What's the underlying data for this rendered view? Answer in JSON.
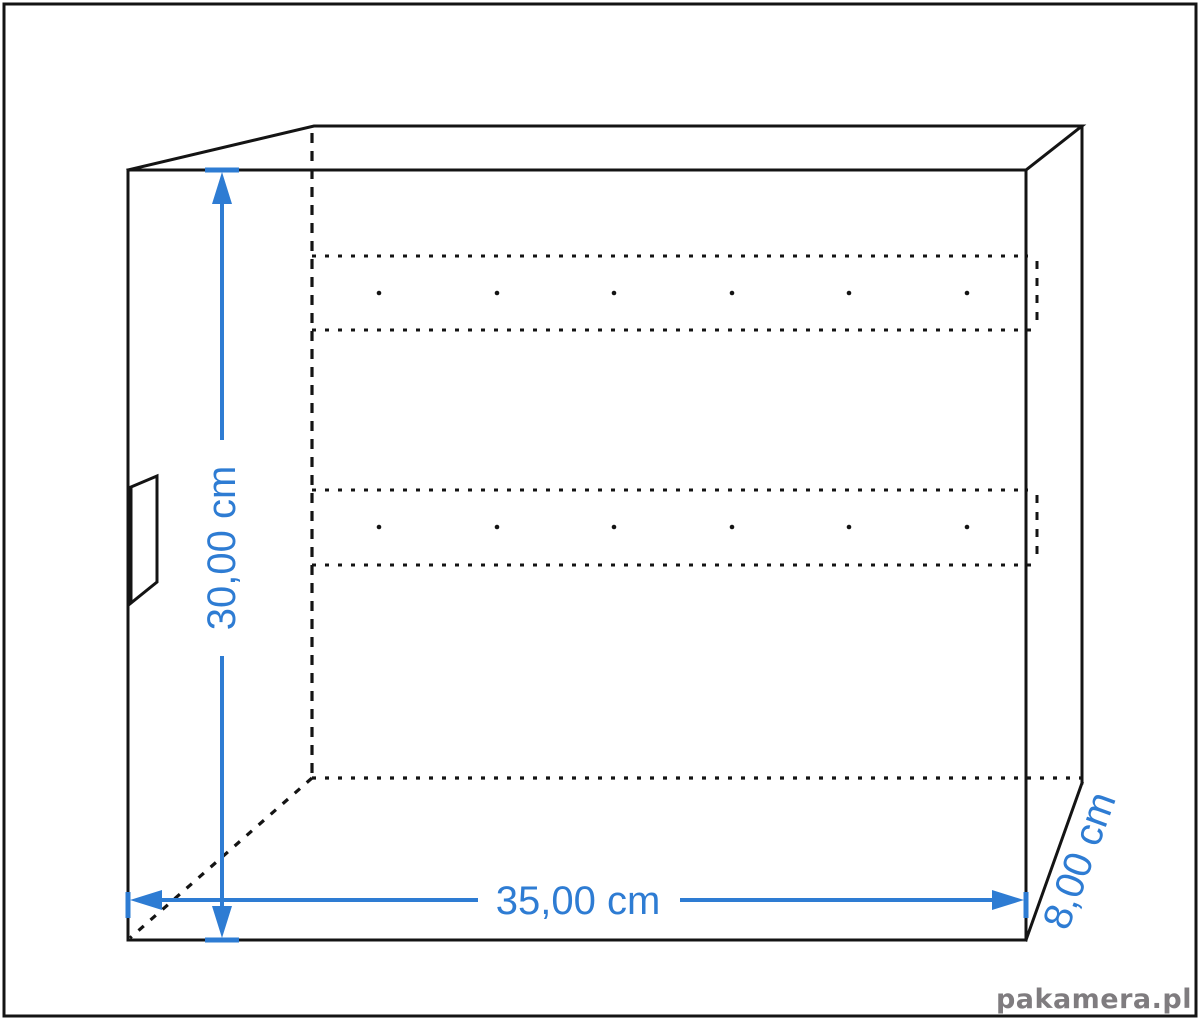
{
  "diagram": {
    "title": "technical drawing of wall box / organizer with dimensions",
    "labels": {
      "height": "30,00 cm",
      "width": "35,00 cm",
      "depth": "8,00 cm"
    },
    "watermark": "pakamera.pl",
    "colors": {
      "line": "#141414",
      "dimension": "#2e7cd3",
      "watermark": "#7f7c7f",
      "background": "#ffffff"
    }
  }
}
